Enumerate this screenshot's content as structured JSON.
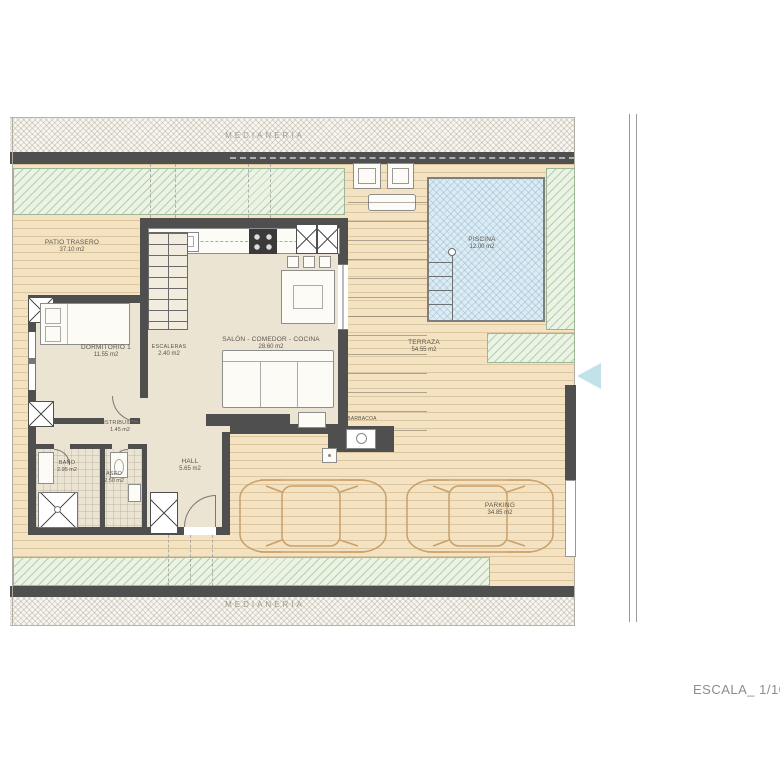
{
  "plan": {
    "medianeria_top": "MEDIANERÍA",
    "medianeria_bottom": "MEDIANERÍA",
    "escala": "ESCALA_ 1/100",
    "rooms": {
      "patio_trasero": {
        "name": "PATIO TRASERO",
        "area": "37.10 m2"
      },
      "dormitorio_1": {
        "name": "DORMITORIO 1",
        "area": "11.55 m2"
      },
      "escaleras": {
        "name": "ESCALERAS",
        "area": "2.40 m2"
      },
      "salon": {
        "name": "SALÓN - COMEDOR - COCINA",
        "area": "28.60 m2"
      },
      "piscina": {
        "name": "PISCINA",
        "area": "12.00 m2"
      },
      "terraza": {
        "name": "TERRAZA",
        "area": "54.55 m2"
      },
      "distribuidor": {
        "name": "DISTRIBUIDOR",
        "area": "1.45 m2"
      },
      "bano": {
        "name": "BAÑO",
        "area": "2.95 m2"
      },
      "aseo": {
        "name": "ASEO",
        "area": "2.50 m2"
      },
      "hall": {
        "name": "HALL",
        "area": "5.65 m2"
      },
      "barbacoa": {
        "name": "BARBACOA"
      },
      "parking": {
        "name": "PARKING",
        "area": "34.85 m2"
      }
    },
    "colors": {
      "wall": "#4f4f4f",
      "deck": "#f3e3c2",
      "lawn": "#eaf3e4",
      "pool": "#dcecf4",
      "interior": "#ece4d3",
      "label_text": "#5b5348"
    }
  }
}
